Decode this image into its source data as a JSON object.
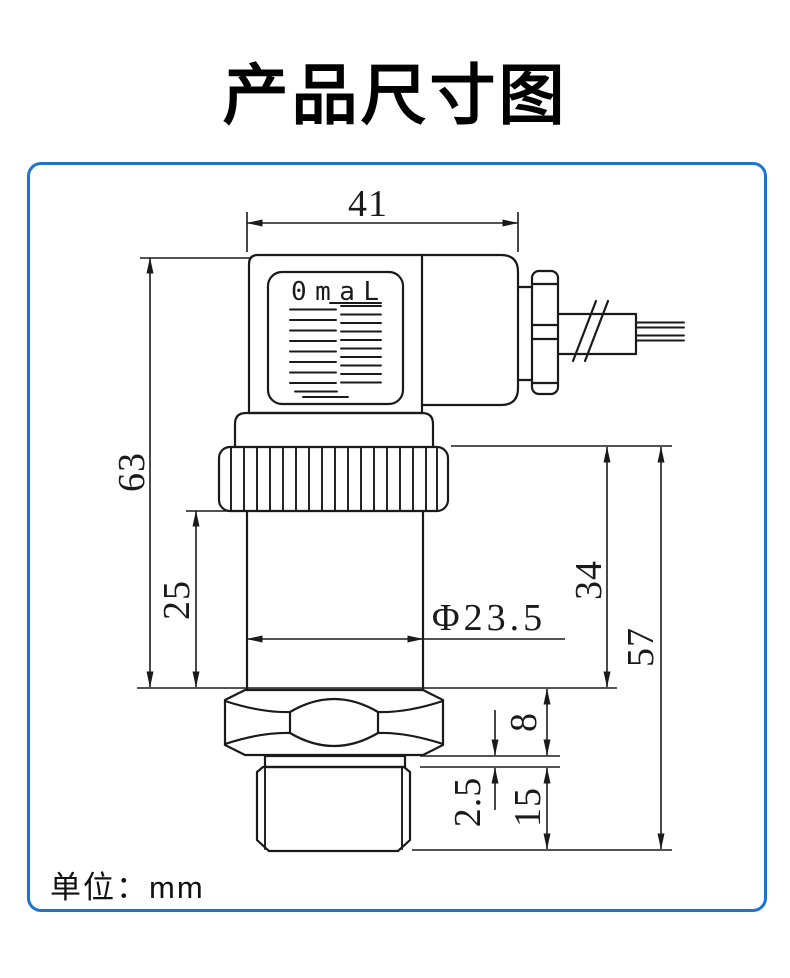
{
  "title": "产品尺寸图",
  "frame": {
    "border_color": "#1d72d2"
  },
  "drawing": {
    "logo_text": "0maL",
    "unit_label": "单位：mm",
    "line_color": "#1a1a1a"
  },
  "dimensions": {
    "connector_width": "41",
    "overall_height": "63",
    "body_height": "25",
    "body_diameter": "Φ23.5",
    "housing_height": "34",
    "housing_total_height": "57",
    "hex_height": "8",
    "washer_thickness": "2.5",
    "thread_length": "15"
  }
}
